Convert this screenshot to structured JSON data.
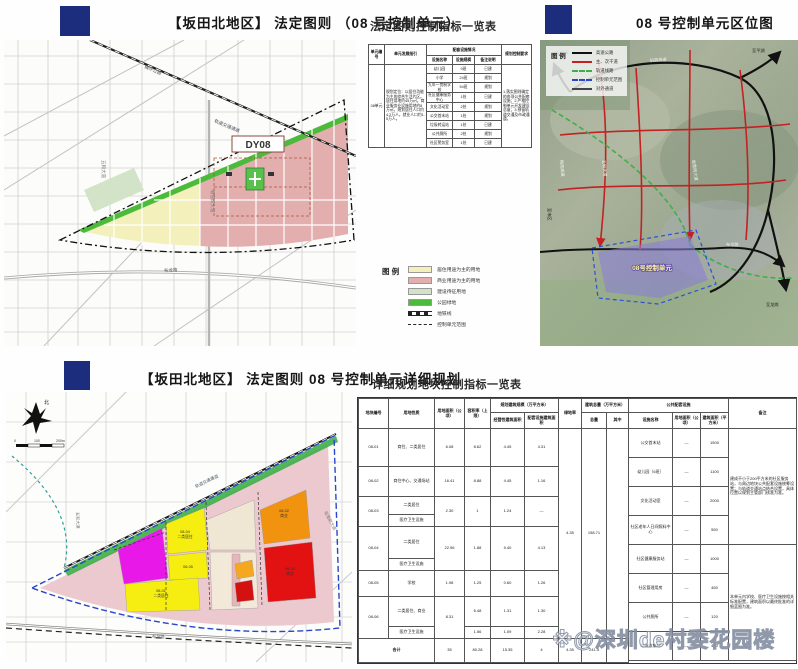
{
  "colors": {
    "navy": "#1c2d7e",
    "road_red": "#c32222",
    "rail_green": "#3fae49",
    "boundary_blue": "#2946cc"
  },
  "panels": {
    "plan": {
      "title": "【坂田北地区】 法定图则 （08 号控制单元）"
    },
    "index_table": {
      "title": "法定图则控制指标一览表"
    },
    "location": {
      "title": "08 号控制单元区位图"
    },
    "detail": {
      "title": "【坂田北地区】 法定图则 08 号控制单元详细规划"
    },
    "detail_table": {
      "title": "详细规划地块控制指标一览表"
    }
  },
  "index_table": {
    "spec": {
      "w": [
        16,
        42,
        26,
        22,
        27,
        30
      ],
      "rows": [
        {
          "h": 11,
          "c": [
            {
              "t": "单元编号",
              "th": 1,
              "rs": 2
            },
            {
              "t": "单元发展指引",
              "th": 1,
              "rs": 2
            },
            {
              "t": "配套设施情况",
              "th": 1,
              "cs": 3
            },
            {
              "t": "规划控制要求",
              "th": 1,
              "rs": 2
            }
          ]
        },
        {
          "h": 9,
          "c": [
            {
              "t": "设施名称",
              "th": 1
            },
            {
              "t": "设施规模",
              "th": 1
            },
            {
              "t": "备注说明",
              "th": 1
            }
          ]
        },
        {
          "h": 9,
          "c": [
            {
              "t": "08单元",
              "rs": 9
            },
            {
              "t": "规划定位：以居住功能为主的综合生活片区。居住用地约45万㎡，商业服务业设施用地约8万㎡。规划居住人口约4.2万人，就业人口约1.5万人。",
              "rs": 9,
              "cl": "tl"
            },
            {
              "t": "幼儿园"
            },
            {
              "t": "9班"
            },
            {
              "t": "已建"
            },
            {
              "t": "1.落实图则确定的各项公共配套设施；2.严格控制单元开发建设总量；3.预留轨道交通及市政通道。",
              "rs": 9,
              "cl": "tl"
            }
          ]
        },
        {
          "h": 9,
          "c": [
            {
              "t": "小学"
            },
            {
              "t": "24班"
            },
            {
              "t": "规划"
            }
          ]
        },
        {
          "h": 9,
          "c": [
            {
              "t": "九年一贯制学校"
            },
            {
              "t": "54班"
            },
            {
              "t": "规划"
            }
          ]
        },
        {
          "h": 9,
          "c": [
            {
              "t": "社区健康服务中心"
            },
            {
              "t": "1处"
            },
            {
              "t": "已建"
            }
          ]
        },
        {
          "h": 9,
          "c": [
            {
              "t": "文化活动室"
            },
            {
              "t": "2处"
            },
            {
              "t": "规划"
            }
          ]
        },
        {
          "h": 9,
          "c": [
            {
              "t": "公交首末站"
            },
            {
              "t": "1处"
            },
            {
              "t": "规划"
            }
          ]
        },
        {
          "h": 9,
          "c": [
            {
              "t": "垃圾转运站"
            },
            {
              "t": "1处"
            },
            {
              "t": "已建"
            }
          ]
        },
        {
          "h": 9,
          "c": [
            {
              "t": "公共厕所"
            },
            {
              "t": "2处"
            },
            {
              "t": "规划"
            }
          ]
        },
        {
          "h": 9,
          "c": [
            {
              "t": "社区警务室"
            },
            {
              "t": "1处"
            },
            {
              "t": "已建"
            }
          ]
        }
      ]
    }
  },
  "legend_plan": {
    "title": "图 例",
    "items": [
      {
        "label": "居住用途为主的用地",
        "sw": "box",
        "color": "#f4f0bc"
      },
      {
        "label": "商业用途为主的用地",
        "sw": "box",
        "color": "#e2aeae"
      },
      {
        "label": "建设待征用地",
        "sw": "box",
        "color": "#d2e3c8"
      },
      {
        "label": "公园绿地",
        "sw": "box",
        "color": "#4cbb3c"
      },
      {
        "label": "地铁线",
        "sw": "rail"
      },
      {
        "label": "控制单元范围",
        "sw": "dashdot"
      }
    ]
  },
  "legend_loc": {
    "title": "图 例",
    "items": [
      {
        "label": "高速公路",
        "sw": "line",
        "color": "#111111"
      },
      {
        "label": "主、次干道",
        "sw": "line",
        "color": "#c32222"
      },
      {
        "label": "轨道线路",
        "sw": "dash",
        "color": "#3fae49"
      },
      {
        "label": "控制单元范围",
        "sw": "dash",
        "color": "#2946cc"
      },
      {
        "label": "对外通道",
        "sw": "line",
        "color": "#444444"
      }
    ]
  },
  "map_plan": {
    "labels": {
      "dy08": "DY08",
      "r1": "横坪公路",
      "r2": "轨道交通通道",
      "r3": "坂雪岗大道",
      "r4": "五和大道",
      "r5": "布龙路"
    }
  },
  "map_loc": {
    "labels": {
      "unit": "08号控制单元",
      "r1": "机荷高速",
      "r2": "梅观高速",
      "r3": "坂雪岗大道",
      "r4": "五和大道",
      "r5": "布龙路",
      "d1": "至观澜",
      "d2": "至平湖",
      "d3": "至龙岗",
      "d4": "至市区"
    }
  },
  "map_detail": {
    "labels": {
      "north": "北",
      "s0": "0",
      "s1": "100",
      "s2": "200m",
      "rail": "轨道交通通道",
      "r1": "布龙路",
      "r2": "五和大道",
      "r3": "坂雪岗大道",
      "p1a": "08-04",
      "p1b": "二类居住",
      "p2a": "08-01",
      "p2b": "二类居住",
      "p3a": "08-02",
      "p3b": "商业",
      "p4a": "08-03",
      "p4b": "商业",
      "p5": "08-05"
    }
  },
  "detail_table": {
    "left": {
      "w": [
        30,
        46,
        30,
        26,
        34,
        34,
        23,
        25,
        22
      ],
      "rows": [
        {
          "h": 14,
          "c": [
            {
              "t": "地块编号",
              "th": 1,
              "rs": 2
            },
            {
              "t": "用地性质",
              "th": 1,
              "rs": 2
            },
            {
              "t": "用地面积（公顷）",
              "th": 1,
              "rs": 2
            },
            {
              "t": "容积率（上限）",
              "th": 1,
              "rs": 2
            },
            {
              "t": "规划建筑规模（万平方米）",
              "th": 1,
              "cs": 2
            },
            {
              "t": "绿地率",
              "th": 1,
              "rs": 2
            },
            {
              "t": "建筑总量（万平方米）",
              "th": 1,
              "cs": 2
            }
          ]
        },
        {
          "h": 16,
          "c": [
            {
              "t": "经营性建筑面积",
              "th": 1
            },
            {
              "t": "配套设施建筑面积",
              "th": 1
            },
            {
              "t": "总量",
              "th": 1
            },
            {
              "t": "其中",
              "th": 1
            }
          ]
        },
        {
          "h": 38,
          "c": [
            {
              "t": "08-01"
            },
            {
              "t": "商住、二类居住"
            },
            {
              "t": "6.08"
            },
            {
              "t": "8.62"
            },
            {
              "t": "4.45"
            },
            {
              "t": "4.31"
            },
            {
              "t": "4.35",
              "rs": 9
            },
            {
              "t": "158.71",
              "rs": 9
            },
            {
              "t": "",
              "rs": 9
            }
          ]
        },
        {
          "h": 30,
          "c": [
            {
              "t": "08-02"
            },
            {
              "t": "商住中心、交通场站"
            },
            {
              "t": "16.41"
            },
            {
              "t": "8.88"
            },
            {
              "t": "4.45"
            },
            {
              "t": "1.16"
            }
          ]
        },
        {
          "h": 18,
          "c": [
            {
              "t": "08-03",
              "rs": 2
            },
            {
              "t": "二类居住"
            },
            {
              "t": "2.30",
              "rs": 2
            },
            {
              "t": "1",
              "rs": 2
            },
            {
              "t": "1.24",
              "rs": 2
            },
            {
              "t": "—",
              "rs": 2
            }
          ]
        },
        {
          "h": 12,
          "c": [
            {
              "t": "医疗卫生设施"
            }
          ]
        },
        {
          "h": 32,
          "c": [
            {
              "t": "08-04",
              "rs": 2
            },
            {
              "t": "二类居住"
            },
            {
              "t": "22.96",
              "rs": 2
            },
            {
              "t": "1.88",
              "rs": 2
            },
            {
              "t": "9.40",
              "rs": 2
            },
            {
              "t": "4.13",
              "rs": 2
            }
          ]
        },
        {
          "h": 12,
          "c": [
            {
              "t": "医疗卫生设施"
            }
          ]
        },
        {
          "h": 26,
          "c": [
            {
              "t": "08-05"
            },
            {
              "t": "学校"
            },
            {
              "t": "1.98"
            },
            {
              "t": "1.25"
            },
            {
              "t": "0.60"
            },
            {
              "t": "1.26"
            }
          ]
        },
        {
          "h": 30,
          "c": [
            {
              "t": "08-06",
              "rs": 2
            },
            {
              "t": "二类居住、商业"
            },
            {
              "t": "8.31",
              "rs": 2
            },
            {
              "t": "6.48"
            },
            {
              "t": "1.31"
            },
            {
              "t": "1.30"
            }
          ]
        },
        {
          "h": 12,
          "c": [
            {
              "t": "医疗卫生设施"
            },
            {
              "t": "1.56"
            },
            {
              "t": "1.09"
            },
            {
              "t": "2.28"
            }
          ]
        },
        {
          "h": 24,
          "c": [
            {
              "t": "合计",
              "cs": 2,
              "th": 1
            },
            {
              "t": "35"
            },
            {
              "t": "80.28"
            },
            {
              "t": "15.35"
            },
            {
              "t": "4"
            },
            {
              "t": "4.35"
            },
            {
              "t": "241.3"
            },
            {
              "t": ""
            }
          ]
        }
      ]
    },
    "right": {
      "w": [
        44,
        28,
        28,
        68
      ],
      "rows": [
        {
          "h": 14,
          "c": [
            {
              "t": "公共配套设施",
              "th": 1,
              "cs": 3
            },
            {
              "t": "备注",
              "th": 1,
              "rs": 2
            }
          ]
        },
        {
          "h": 16,
          "c": [
            {
              "t": "设施名称",
              "th": 1
            },
            {
              "t": "用地面积（公顷）",
              "th": 1
            },
            {
              "t": "建筑面积（平方米）",
              "th": 1
            }
          ]
        },
        {
          "h": 29,
          "c": [
            {
              "t": "公交首末站"
            },
            {
              "t": "—"
            },
            {
              "t": "1500"
            },
            {
              "t": "建成不小于200平方米的社区服务站，与周边地块公共配套设施统筹设置；与轨道交通站点结合设置，具体位置以规划主管部门核准为准。",
              "rs": 4,
              "cl": "tl"
            }
          ]
        },
        {
          "h": 29,
          "c": [
            {
              "t": "幼儿园（6班）"
            },
            {
              "t": "—"
            },
            {
              "t": "1100"
            }
          ]
        },
        {
          "h": 29,
          "c": [
            {
              "t": "文化活动室"
            },
            {
              "t": "—"
            },
            {
              "t": "2000"
            }
          ]
        },
        {
          "h": 29,
          "c": [
            {
              "t": "社区老年人日间照料中心"
            },
            {
              "t": "—"
            },
            {
              "t": "550"
            }
          ]
        },
        {
          "h": 29,
          "c": [
            {
              "t": "社区健康服务站"
            },
            {
              "t": "—"
            },
            {
              "t": "1000"
            },
            {
              "t": "本单元内学校、医疗卫生设施按相关标准配置，建筑面积以最终批准的详细蓝图为准。",
              "rs": 4,
              "cl": "tl"
            }
          ]
        },
        {
          "h": 29,
          "c": [
            {
              "t": "社区管理用房"
            },
            {
              "t": "—"
            },
            {
              "t": "450"
            }
          ]
        },
        {
          "h": 29,
          "c": [
            {
              "t": "公共厕所"
            },
            {
              "t": "—"
            },
            {
              "t": "120"
            }
          ]
        },
        {
          "h": 29,
          "c": [
            {
              "t": "垃圾收集站"
            },
            {
              "t": "—"
            },
            {
              "t": "400"
            }
          ]
        }
      ]
    }
  },
  "watermark": {
    "text": "※@深圳de村委花园楼"
  }
}
